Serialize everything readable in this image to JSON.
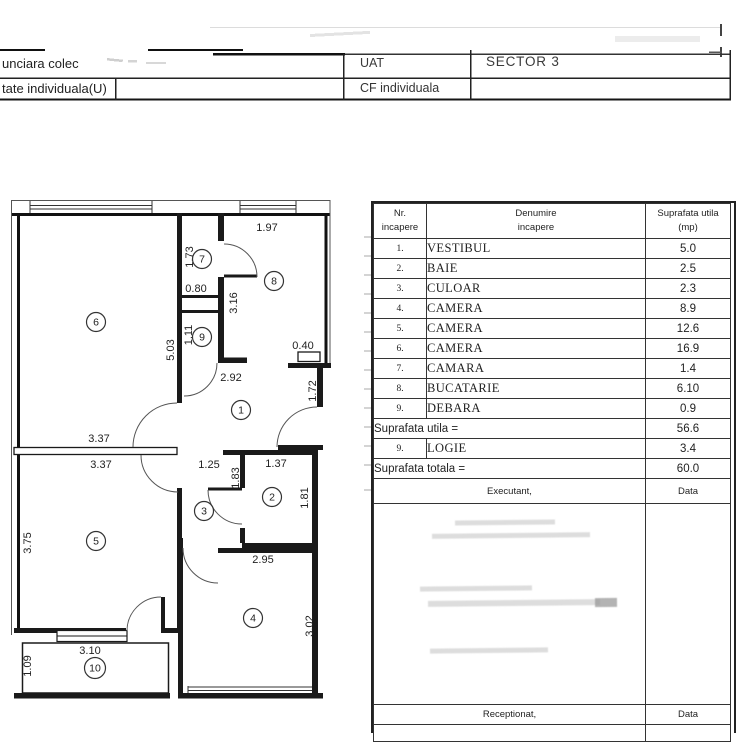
{
  "header": {
    "row1_left": "unciara colec",
    "uat_label": "UAT",
    "uat_value": "SECTOR 3",
    "row2_left": "tate individuala(U)",
    "cf_label": "CF individuala",
    "cf_value": ""
  },
  "table": {
    "headers": {
      "nr1": "Nr.",
      "nr2": "incapere",
      "den1": "Denumire",
      "den2": "incapere",
      "sup1": "Suprafata utila",
      "sup2": "(mp)"
    },
    "rows": [
      {
        "nr": "1.",
        "name": "VESTIBUL",
        "area": "5.0"
      },
      {
        "nr": "2.",
        "name": "BAIE",
        "area": "2.5"
      },
      {
        "nr": "3.",
        "name": "CULOAR",
        "area": "2.3"
      },
      {
        "nr": "4.",
        "name": "CAMERA",
        "area": "8.9"
      },
      {
        "nr": "5.",
        "name": "CAMERA",
        "area": "12.6"
      },
      {
        "nr": "6.",
        "name": "CAMERA",
        "area": "16.9"
      },
      {
        "nr": "7.",
        "name": "CAMARA",
        "area": "1.4"
      },
      {
        "nr": "8.",
        "name": "BUCATARIE",
        "area": "6.10"
      },
      {
        "nr": "9.",
        "name": "DEBARA",
        "area": "0.9"
      }
    ],
    "subtotal": {
      "label": "Suprafata utila =",
      "value": "56.6"
    },
    "logie": {
      "nr": "9.",
      "name": "LOGIE",
      "area": "3.4"
    },
    "total": {
      "label": "Suprafata totala =",
      "value": "60.0"
    },
    "executant_label": "Executant,",
    "data_label_1": "Data",
    "receptionat_label": "Receptionat,",
    "data_label_2": "Data"
  },
  "plan": {
    "rooms": {
      "r1": "1",
      "r2": "2",
      "r3": "3",
      "r4": "4",
      "r5": "5",
      "r6": "6",
      "r7": "7",
      "r8": "8",
      "r9": "9",
      "r10": "10"
    },
    "dims": {
      "h197": "1.97",
      "v173": "1.73",
      "h080": "0.80",
      "v316": "3.16",
      "v503": "5.03",
      "v111": "1.11",
      "h040": "0.40",
      "h292": "2.92",
      "v172": "1.72",
      "h337a": "3.37",
      "h337b": "3.37",
      "h125": "1.25",
      "h137": "1.37",
      "v183": "1.83",
      "v181": "1.81",
      "v375": "3.75",
      "h295": "2.95",
      "v302": "3.02",
      "h310": "3.10",
      "v109": "1.09"
    }
  }
}
